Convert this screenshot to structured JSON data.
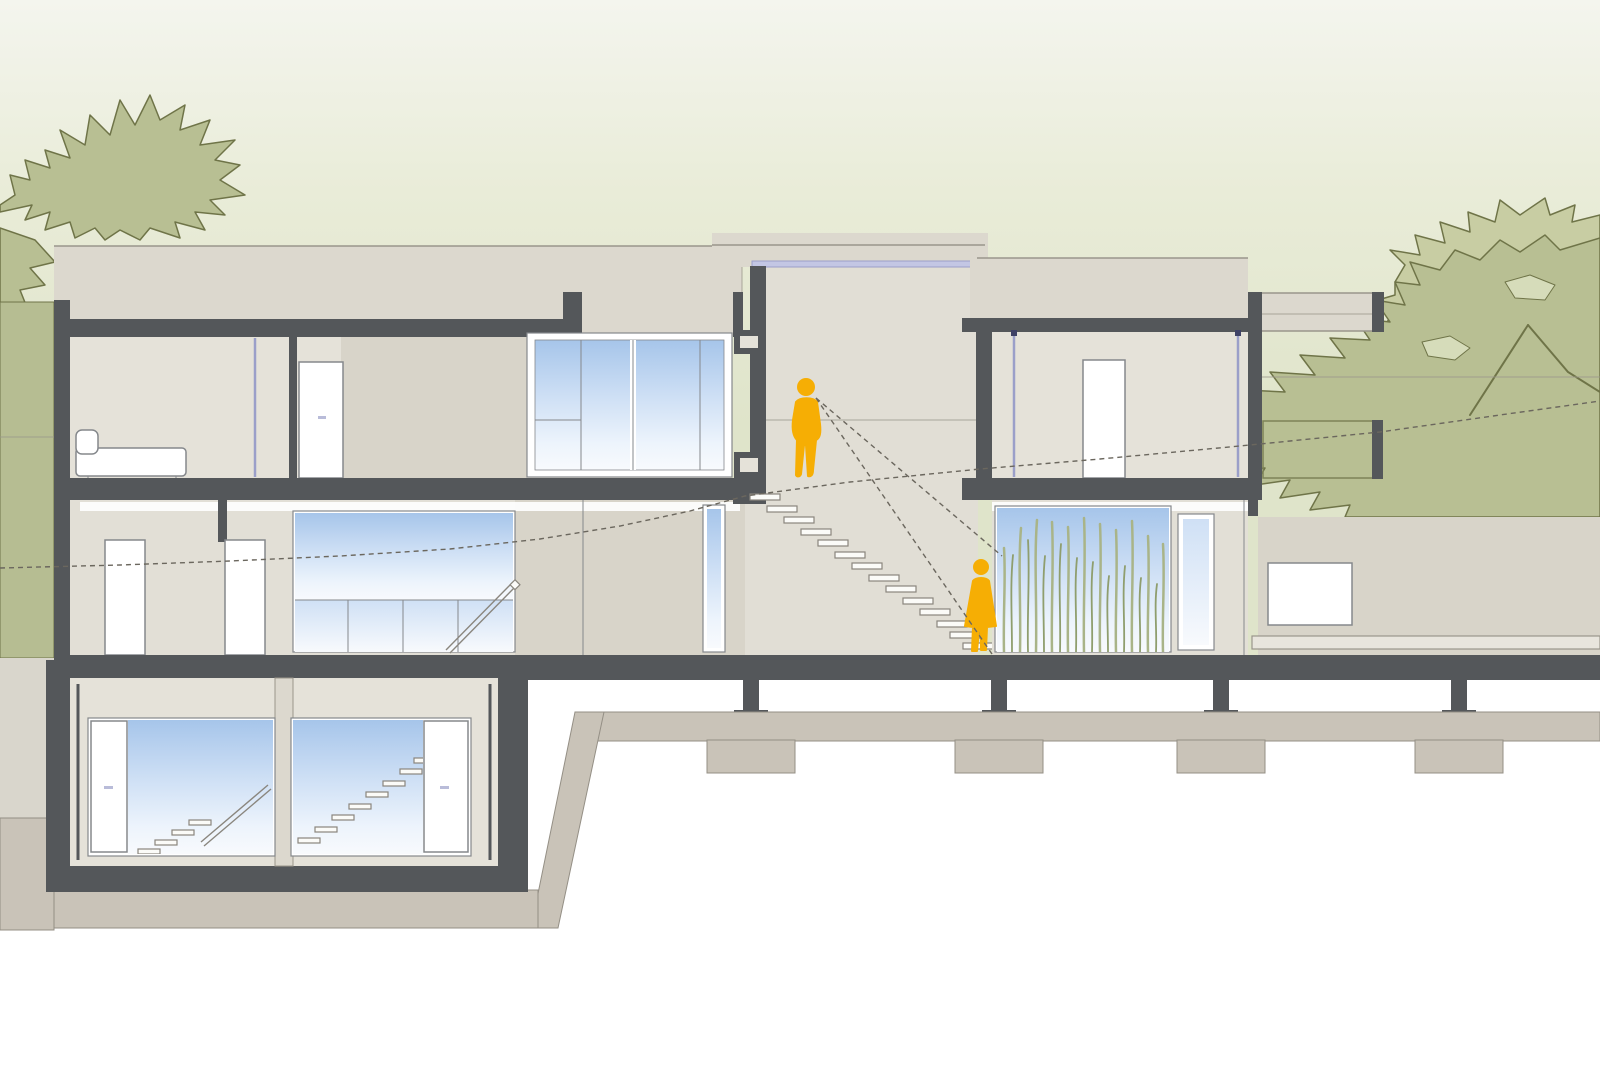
{
  "meta": {
    "title": "Architectural cross-section drawing of a three-level modern house with two human figures",
    "drawing_type": "building long section / elevation",
    "text_on_image": "none"
  },
  "palette": {
    "bg-top": "#f4f5ee",
    "bg-mid": "#e9ecd8",
    "bg-green": "#dfe4ca",
    "tree": "#b8bf93",
    "tree-light": "#c8cda3",
    "tree-hole": "#d6dcba",
    "tree-outline": "#6f7448",
    "terrain": "#b6bd92",
    "structure": "#54575a",
    "wall": "#dcd8ce",
    "wall-shade": "#d8d4c9",
    "interior": "#e5e2d9",
    "interior-alt": "#e2dfd6",
    "hall": "#e1ded5",
    "white": "#ffffff",
    "frame-stroke": "#85888c",
    "glass-top": "#a6c5ea",
    "glass-mid": "#cfe0f5",
    "glass-low": "#edf4fc",
    "glass-pale": "#f8fafd",
    "lavender": "#9b9fc9",
    "lavender-light": "#c3c6e4",
    "ground-beige": "#c9c3b8",
    "ground-beige-edge": "#948f85",
    "ground-light": "#d9d6cc",
    "figure": "#f6ae04",
    "reed": "#a9b488",
    "reed-dark": "#8f9e6e",
    "dash-line": "#6b675e",
    "step-fill": "#fbfbf8",
    "step-stroke": "#8a867e",
    "thin-line": "#9a968b",
    "bench": "#e8e5dd"
  },
  "scene": {
    "levels": [
      "upper-floor",
      "ground-floor",
      "basement"
    ],
    "figures": [
      {
        "name": "man-walking",
        "location": "central stair hall, upper landing",
        "color_ref": "figure"
      },
      {
        "name": "woman-standing",
        "location": "bottom of central stair at ground floor",
        "color_ref": "figure"
      }
    ],
    "annotations": [
      {
        "name": "grade-dashed-line",
        "desc": "dashed site-grade line rising gently from left to right across whole drawing"
      },
      {
        "name": "sight-lines",
        "desc": "two dashed view lines radiating from the man's head down the stair toward the woman"
      }
    ],
    "elements": [
      "left-two-storey-block with bedroom, bed, doors and large glazed window",
      "central-stair-tower with floating steps descending to the right",
      "right-wing with room, door and cantilevered canopy",
      "ground-floor reed-planted glass window",
      "basement with two glazed openings showing interior stairs",
      "foundation strip with piers and footings",
      "tree silhouettes left and right",
      "garden wall with small white window and bench at right"
    ]
  }
}
